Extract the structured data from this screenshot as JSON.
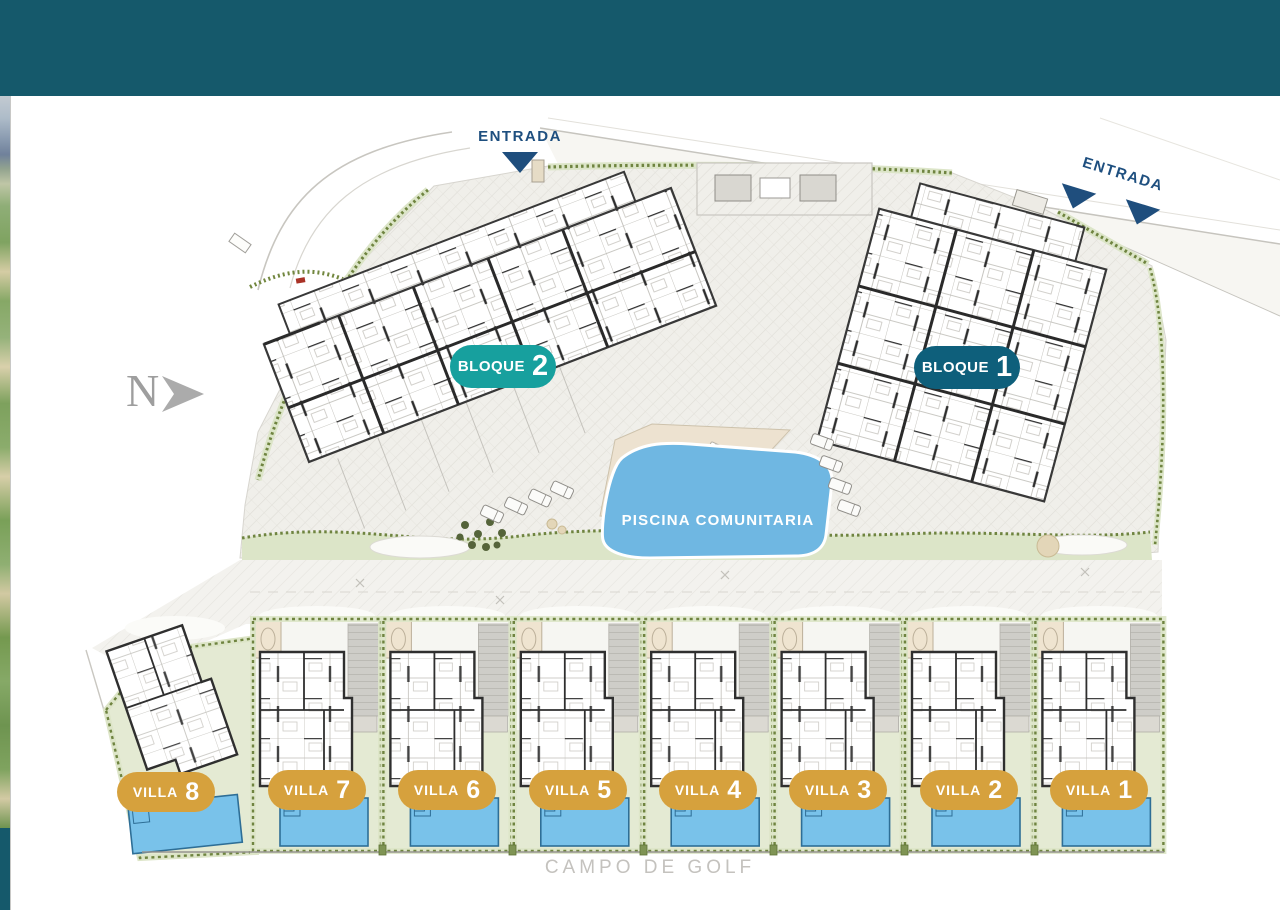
{
  "labels": {
    "entrada_top": "ENTRADA",
    "entrada_right": "ENTRADA",
    "north_letter": "N",
    "pool": "PISCINA COMUNITARIA",
    "golf": "CAMPO DE GOLF"
  },
  "bloques": [
    {
      "word": "BLOQUE",
      "number": "2",
      "color": "#17A09E"
    },
    {
      "word": "BLOQUE",
      "number": "1",
      "color": "#0E5F7B"
    }
  ],
  "villas": [
    {
      "word": "VILLA",
      "number": "8"
    },
    {
      "word": "VILLA",
      "number": "7"
    },
    {
      "word": "VILLA",
      "number": "6"
    },
    {
      "word": "VILLA",
      "number": "5"
    },
    {
      "word": "VILLA",
      "number": "4"
    },
    {
      "word": "VILLA",
      "number": "3"
    },
    {
      "word": "VILLA",
      "number": "2"
    },
    {
      "word": "VILLA",
      "number": "1"
    }
  ],
  "colors": {
    "header": "#15596B",
    "villa_badge": "#D6A13D",
    "entrada_text": "#1E4F7F",
    "community_pool": "#6FB7E2",
    "villa_pool": "#79C2EA",
    "lawn": "#E4EAD3",
    "hedge": "#6F8440",
    "golf_text": "#C4C2BE"
  }
}
